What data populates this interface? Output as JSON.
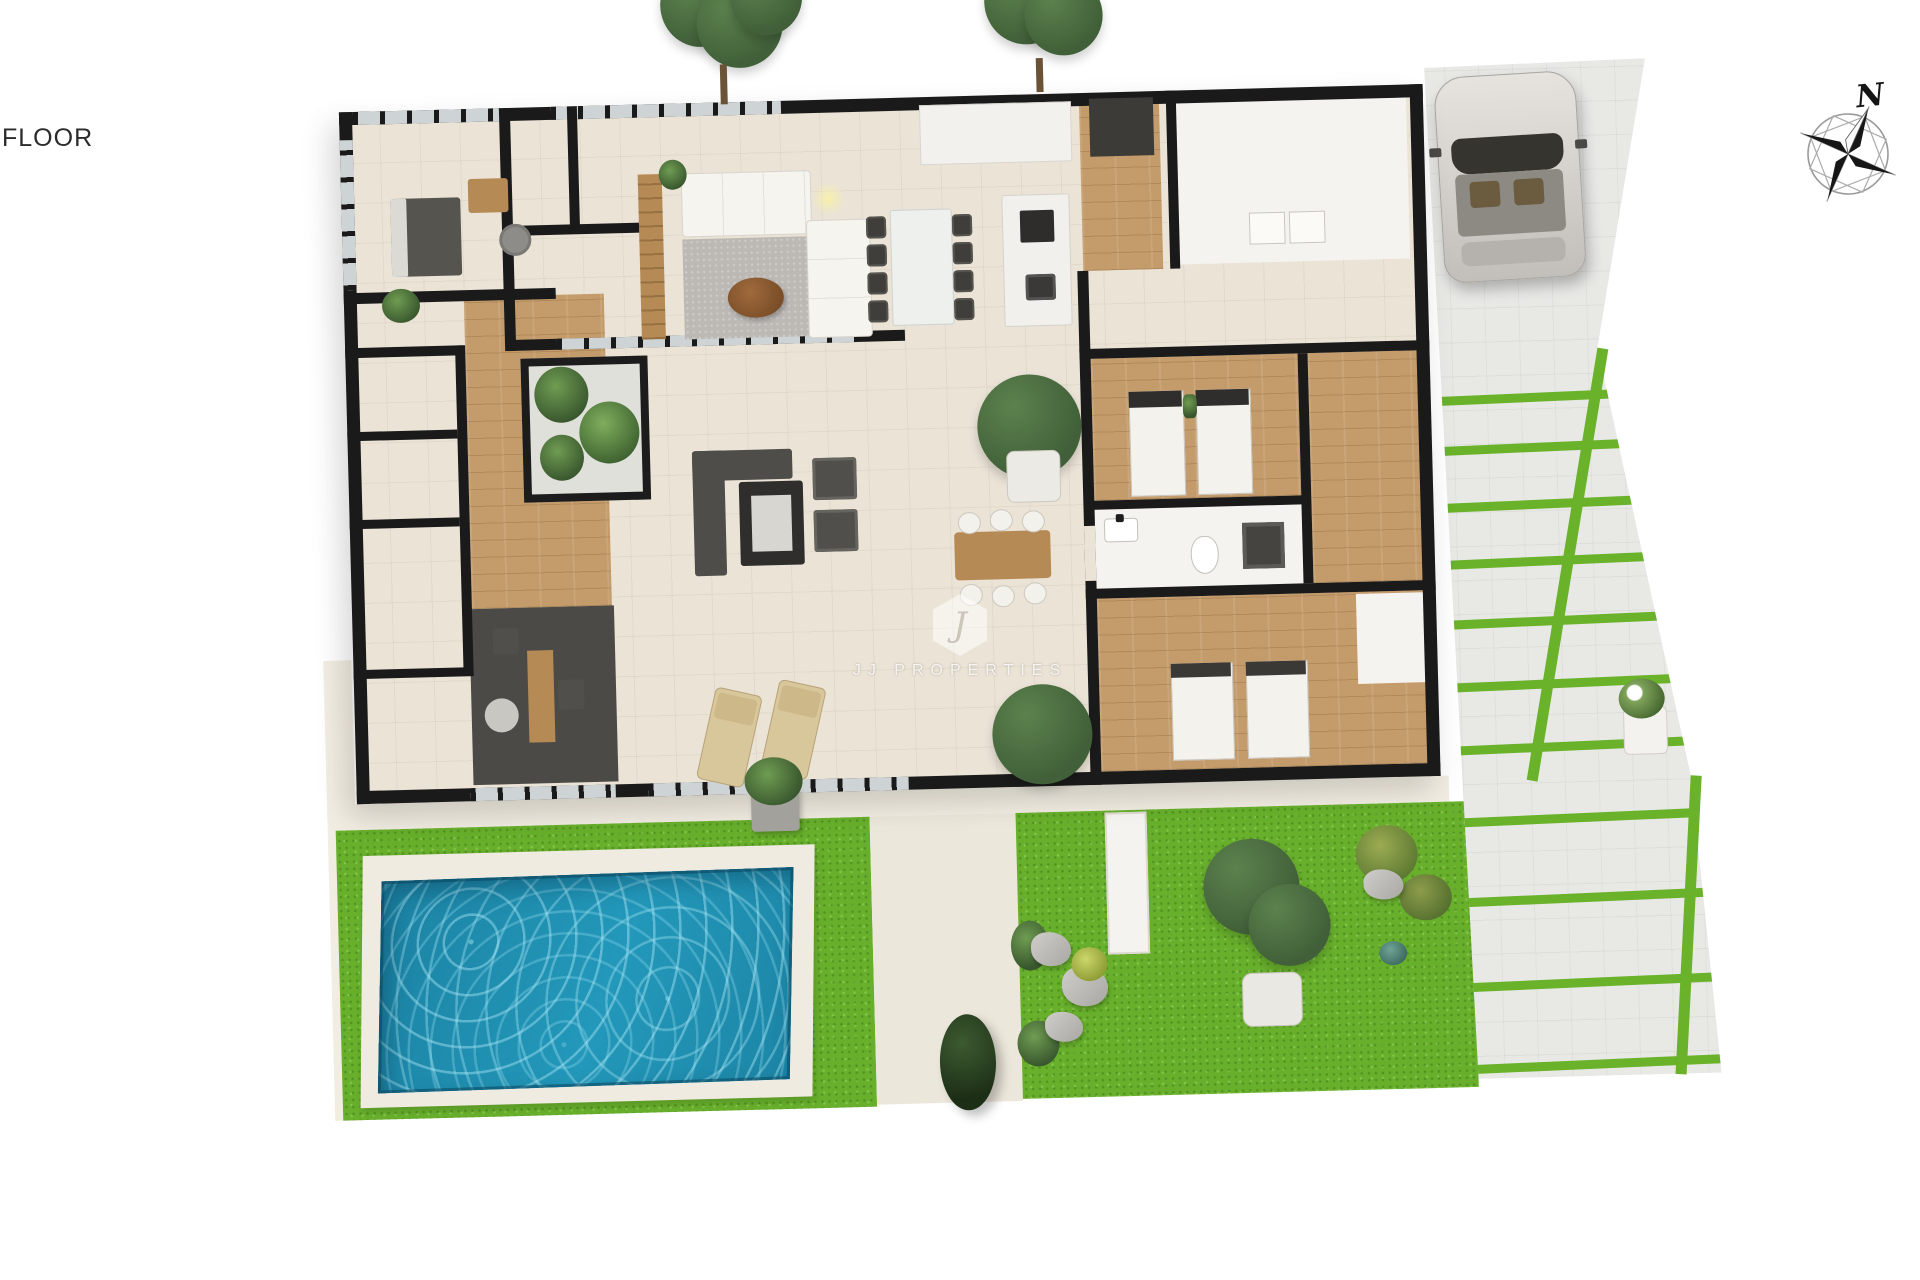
{
  "labels": {
    "floor": "FLOOR"
  },
  "compass": {
    "north": "N"
  },
  "watermark": {
    "monogram": "J",
    "name": "JJ PROPERTIES"
  },
  "colors": {
    "background": "#ffffff",
    "wall": "#1a1a1a",
    "floor_tile": "#eae3d6",
    "wood": "#c49b6a",
    "wood_dark": "#b68a55",
    "grass": "#68b02c",
    "grass_dark": "#59a324",
    "pool_water": "#2398ba",
    "pool_deep": "#1b7fa0",
    "pool_ripple": "#9fdcec",
    "pool_deck": "#f0ebe1",
    "paving": "#e8e8e5",
    "paving_strip": "#69b229",
    "car_body": "#d8d5d0",
    "sofa_white": "#f6f4ef",
    "furniture_dark": "#504f4b",
    "rug_gray": "#bcb9b5",
    "canopy": "#42603a",
    "canopy_light": "#5d8050",
    "cream_wall": "#f2ede2",
    "glass": "#ced3d5"
  }
}
